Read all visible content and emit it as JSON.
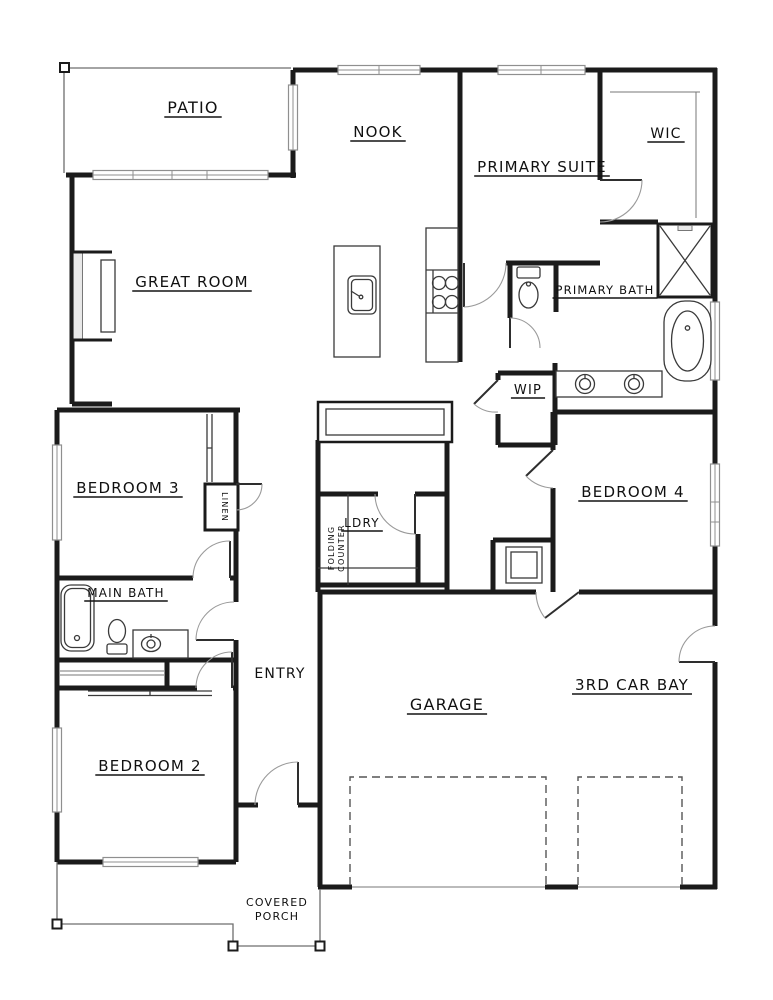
{
  "plan": {
    "title": "single-story house floor plan",
    "rooms": {
      "patio": {
        "label": "PATIO"
      },
      "nook": {
        "label": "NOOK"
      },
      "primary_suite": {
        "label": "PRIMARY SUITE"
      },
      "wic": {
        "label": "WIC"
      },
      "great_room": {
        "label": "GREAT ROOM"
      },
      "primary_bath": {
        "label": "PRIMARY BATH"
      },
      "wip": {
        "label": "WIP"
      },
      "bedroom_3": {
        "label": "BEDROOM 3"
      },
      "bedroom_4": {
        "label": "BEDROOM 4"
      },
      "laundry": {
        "label": "LDRY"
      },
      "main_bath": {
        "label": "MAIN BATH"
      },
      "entry": {
        "label": "ENTRY"
      },
      "bedroom_2": {
        "label": "BEDROOM 2"
      },
      "garage": {
        "label": "GARAGE"
      },
      "third_car_bay": {
        "label": "3RD CAR BAY"
      },
      "linen": {
        "label": "LINEN"
      },
      "folding_counter": {
        "lines": [
          "FOLDING",
          "COUNTER"
        ]
      },
      "covered_porch": {
        "lines": [
          "COVERED",
          "PORCH"
        ]
      }
    },
    "colors": {
      "walls": "#1b1b1b",
      "paper": "#ffffff",
      "window": "#8f9a9a",
      "dashed": "#555555"
    }
  }
}
